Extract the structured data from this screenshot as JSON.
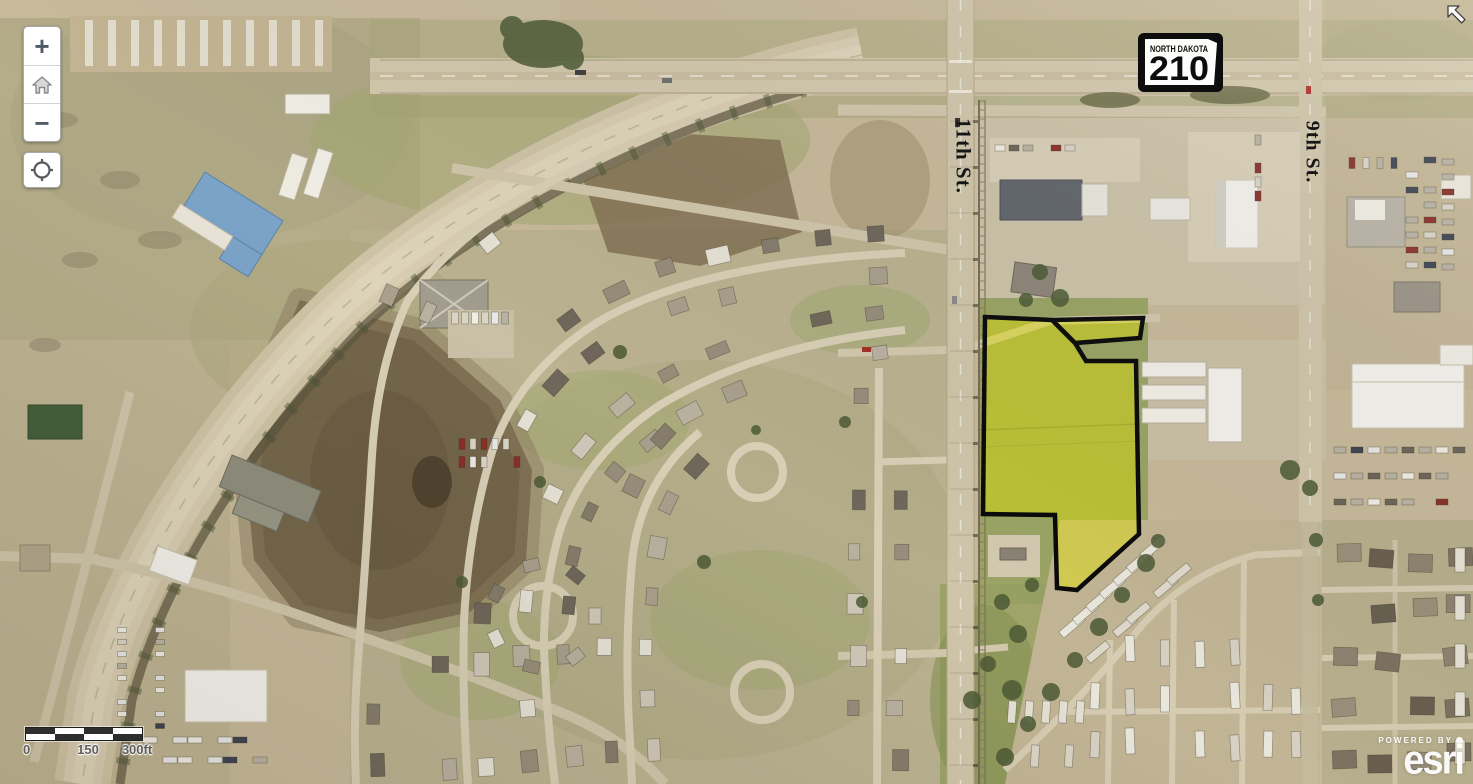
{
  "map": {
    "highway_shield": {
      "state_name": "NORTH DAKOTA",
      "route_number": "210"
    },
    "street_labels": {
      "street_11th": "11th St.",
      "street_9th": "9th St."
    },
    "scale_bar": {
      "label_0": "0",
      "label_mid": "150",
      "label_end": "300ft"
    },
    "attribution": {
      "powered_by": "POWERED BY",
      "brand": "esri"
    },
    "zoom_controls": {
      "zoom_in": "+",
      "zoom_out": "−"
    },
    "parcel_highlight": {
      "fill": "#e4e400",
      "fill_opacity": 0.45,
      "stroke": "#0a0a0a",
      "stroke_width": 4.5,
      "main_points": "985,317 1052,320 1075,343 1086,361 1136,361 1139,534 1077,590 1057,588 1055,515 983,514",
      "strip_points": "1052,320 1143,318 1140,338 1075,343"
    }
  }
}
